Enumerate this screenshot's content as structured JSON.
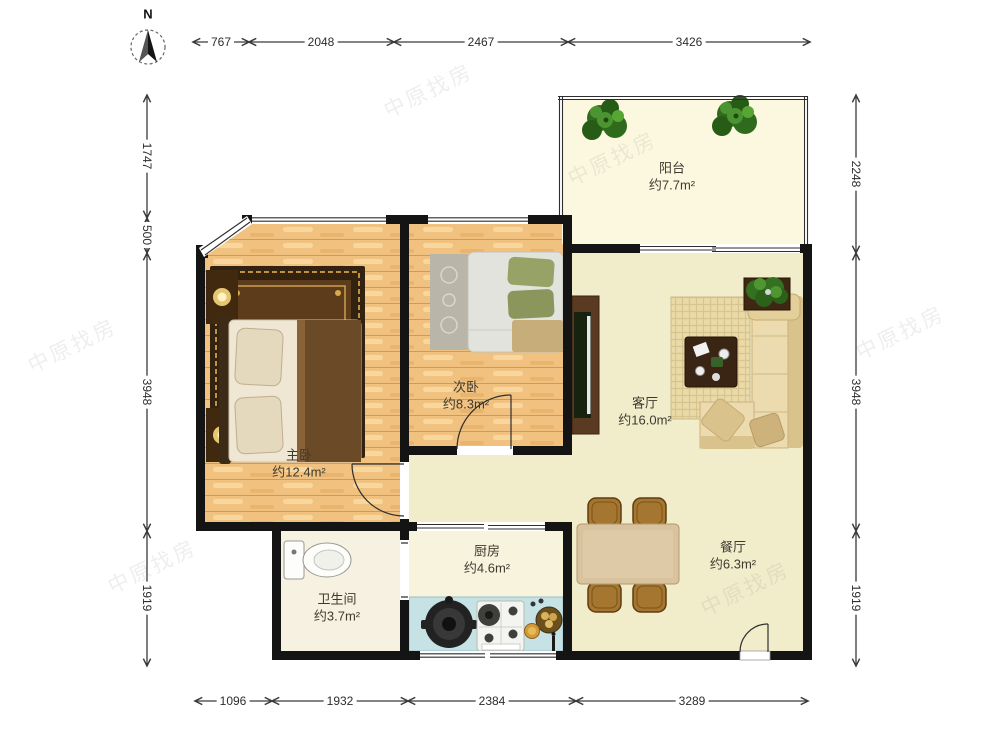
{
  "compass": {
    "label": "N"
  },
  "watermark": {
    "text": "中原找房"
  },
  "rooms": {
    "balcony": {
      "name": "阳台",
      "area": "约7.7m²"
    },
    "second_bedroom": {
      "name": "次卧",
      "area": "约8.3m²"
    },
    "master_bedroom": {
      "name": "主卧",
      "area": "约12.4m²"
    },
    "living_room": {
      "name": "客厅",
      "area": "约16.0m²"
    },
    "kitchen": {
      "name": "厨房",
      "area": "约4.6m²"
    },
    "bathroom": {
      "name": "卫生间",
      "area": "约3.7m²"
    },
    "dining_room": {
      "name": "餐厅",
      "area": "约6.3m²"
    }
  },
  "dimensions_mm": {
    "top": [
      "767",
      "2048",
      "2467",
      "3426"
    ],
    "left": [
      "1747",
      "500",
      "3948",
      "1919"
    ],
    "right": [
      "2248",
      "3948",
      "1919"
    ],
    "bottom": [
      "1096",
      "1932",
      "2384",
      "3289"
    ]
  },
  "colors": {
    "wall": "#141414",
    "wood_floor": "#f1c17f",
    "living_floor": "#f1ecca",
    "balcony_floor": "#fbf8df",
    "bathroom_floor": "#f6f1e1",
    "kitchen_floor": "#f8f3dd",
    "kitchen_counter": "#c6e2e5",
    "master_rug": "#5d3c1c",
    "sofa": "#ecdbae",
    "plant_green": "#33701f",
    "dining_chair": "#a5762f"
  }
}
